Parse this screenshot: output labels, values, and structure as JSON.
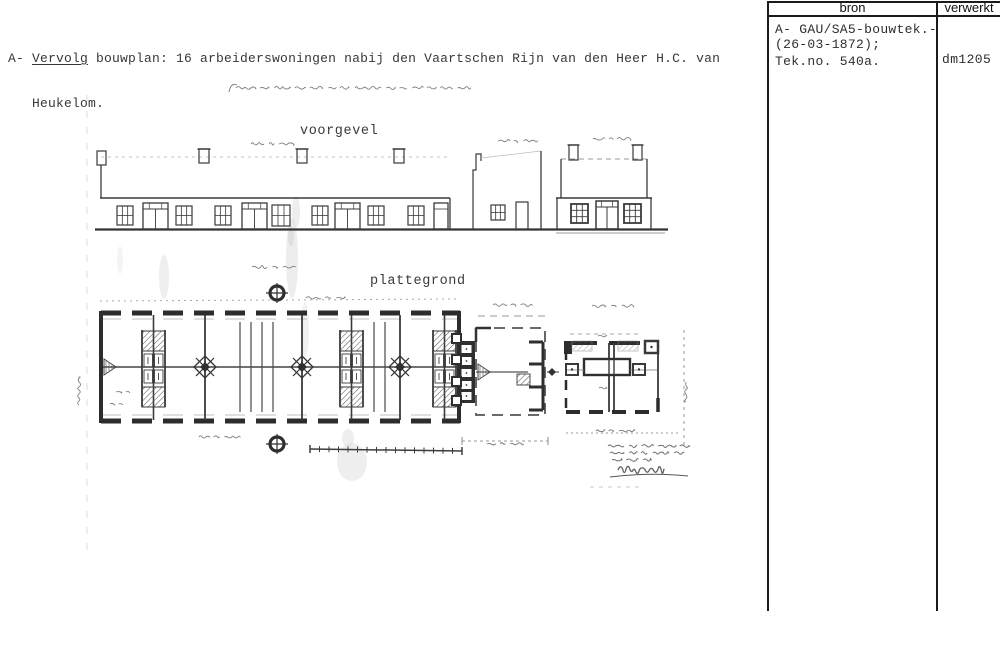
{
  "header": {
    "prefix": "A- ",
    "underlined": "Vervolg",
    "rest": " bouwplan: 16 arbeiderswoningen nabij den Vaartschen Rijn van den Heer H.C. van",
    "line2": "Heukelom."
  },
  "ref_table": {
    "col_source": "bron",
    "col_processed": "verwerkt",
    "source_lines": [
      "A- GAU/SA5-bouwtek.-",
      "(26-03-1872);",
      "Tek.no. 540a."
    ],
    "processed": "dm1205"
  },
  "drawing": {
    "label_elevation": "voorgevel",
    "label_floorplan": "plattegrond"
  },
  "colors": {
    "ink": "#3a3a3a",
    "plan_wall": "#2c2c2c",
    "handwriting": "#787878",
    "table_line": "#1b1b1b",
    "paper": "#ffffff"
  }
}
